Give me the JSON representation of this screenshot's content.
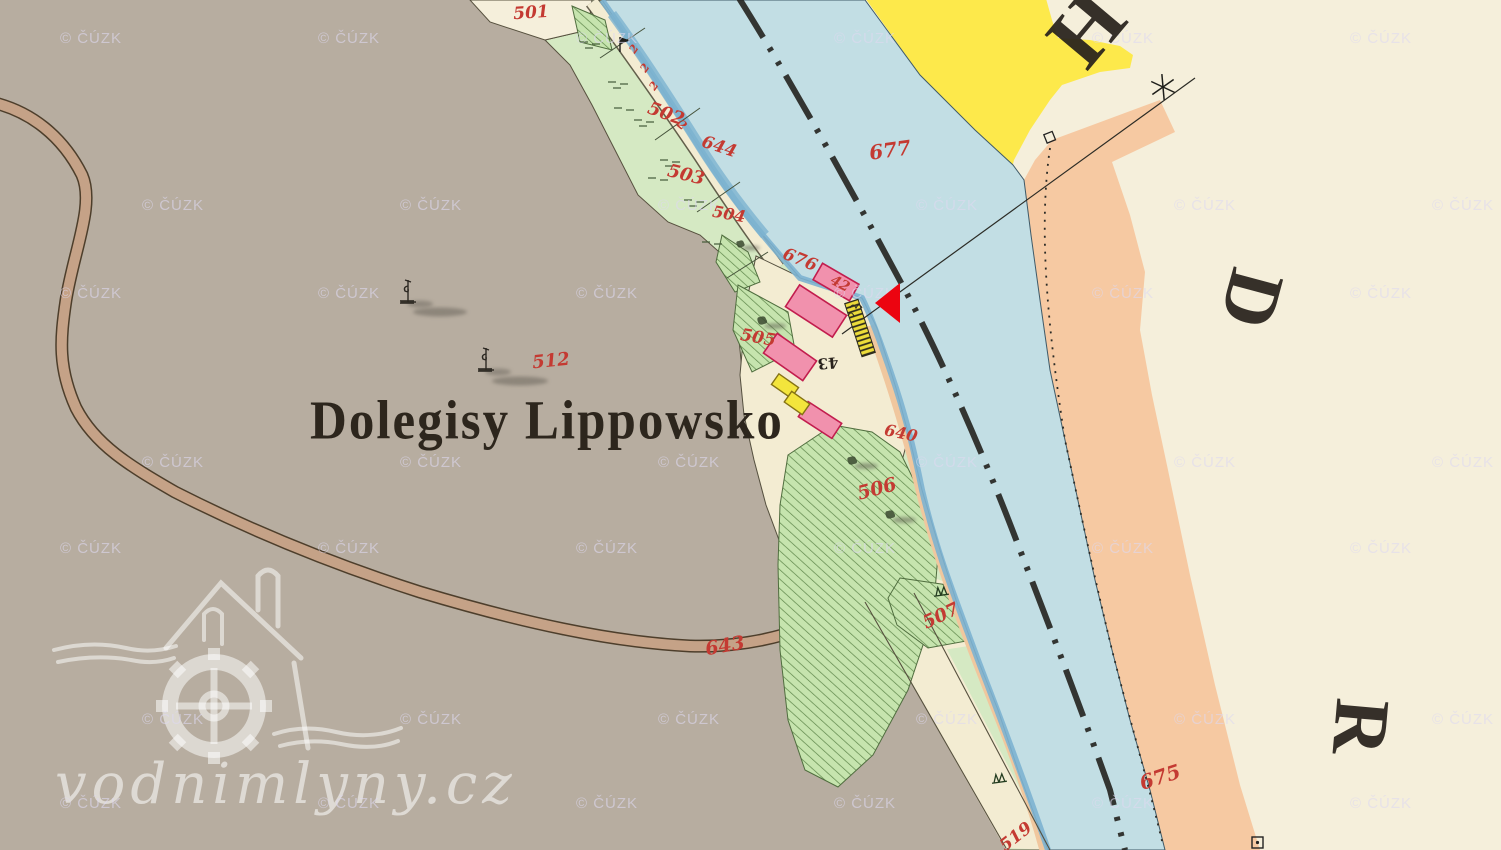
{
  "map": {
    "place_label": "Dolegisy Lippowsko",
    "sheet_letters": [
      {
        "name": "sheet-letter-h",
        "char": "H",
        "x": 1086,
        "y": 28,
        "rot": -50,
        "size": 86
      },
      {
        "name": "sheet-letter-d",
        "char": "D",
        "x": 1252,
        "y": 299,
        "rot": 105,
        "size": 78
      },
      {
        "name": "sheet-letter-r",
        "char": "R",
        "x": 1361,
        "y": 727,
        "rot": 95,
        "size": 78
      }
    ],
    "labels": [
      {
        "name": "parcel-label-501",
        "text": "501",
        "x": 531,
        "y": 13,
        "rot": -4,
        "size": 17,
        "color": "red"
      },
      {
        "name": "parcel-label-502",
        "text": "502",
        "x": 666,
        "y": 114,
        "rot": 20,
        "size": 18,
        "color": "red"
      },
      {
        "name": "strip-mark-2d",
        "text": "2",
        "x": 682,
        "y": 125,
        "rot": 40,
        "size": 12,
        "color": "red"
      },
      {
        "name": "parcel-label-503",
        "text": "503",
        "x": 686,
        "y": 175,
        "rot": 14,
        "size": 18,
        "color": "red"
      },
      {
        "name": "parcel-label-644",
        "text": "644",
        "x": 719,
        "y": 147,
        "rot": 18,
        "size": 17,
        "color": "red"
      },
      {
        "name": "parcel-label-504",
        "text": "504",
        "x": 729,
        "y": 214,
        "rot": 10,
        "size": 16,
        "color": "red"
      },
      {
        "name": "parcel-label-676",
        "text": "676",
        "x": 800,
        "y": 260,
        "rot": 22,
        "size": 17,
        "color": "red"
      },
      {
        "name": "house-number-42",
        "text": "42",
        "x": 840,
        "y": 284,
        "rot": 28,
        "size": 14,
        "color": "red"
      },
      {
        "name": "parcel-label-505",
        "text": "505",
        "x": 758,
        "y": 338,
        "rot": 10,
        "size": 17,
        "color": "red"
      },
      {
        "name": "house-number-43",
        "text": "43",
        "x": 828,
        "y": 363,
        "rot": 175,
        "size": 15,
        "color": "black"
      },
      {
        "name": "parcel-label-640",
        "text": "640",
        "x": 901,
        "y": 433,
        "rot": 12,
        "size": 16,
        "color": "red"
      },
      {
        "name": "parcel-label-506",
        "text": "506",
        "x": 877,
        "y": 489,
        "rot": -15,
        "size": 19,
        "color": "red"
      },
      {
        "name": "parcel-label-507",
        "text": "507",
        "x": 941,
        "y": 616,
        "rot": -25,
        "size": 18,
        "color": "red"
      },
      {
        "name": "parcel-label-643",
        "text": "643",
        "x": 725,
        "y": 646,
        "rot": -10,
        "size": 19,
        "color": "red"
      },
      {
        "name": "parcel-label-519",
        "text": "519",
        "x": 1016,
        "y": 837,
        "rot": -38,
        "size": 17,
        "color": "red"
      },
      {
        "name": "parcel-label-512",
        "text": "512",
        "x": 551,
        "y": 361,
        "rot": -6,
        "size": 18,
        "color": "red"
      },
      {
        "name": "river-label-677",
        "text": "677",
        "x": 890,
        "y": 150,
        "rot": -8,
        "size": 20,
        "color": "red"
      },
      {
        "name": "river-label-675",
        "text": "675",
        "x": 1160,
        "y": 777,
        "rot": -18,
        "size": 20,
        "color": "red"
      },
      {
        "name": "strip-mark-2a",
        "text": "2",
        "x": 634,
        "y": 49,
        "rot": -55,
        "size": 11,
        "color": "red"
      },
      {
        "name": "strip-mark-2b",
        "text": "2",
        "x": 645,
        "y": 68,
        "rot": -55,
        "size": 11,
        "color": "red"
      },
      {
        "name": "strip-mark-2c",
        "text": "2",
        "x": 654,
        "y": 86,
        "rot": -55,
        "size": 11,
        "color": "red"
      }
    ]
  },
  "marker": {
    "label": "mill-location"
  },
  "watermark": {
    "text": "© ČÚZK",
    "gridA": {
      "x0": 60,
      "y0": 30,
      "dx": 258,
      "dy": 255,
      "cols": 6,
      "rows": 4
    },
    "gridB": {
      "x0": 142,
      "y0": 197,
      "dx": 258,
      "dy": 257,
      "cols": 6,
      "rows": 3
    }
  },
  "logo": {
    "text": "vodnimlyny.cz"
  },
  "colors": {
    "paper": "#f5efdb",
    "gray_field": "#b7ada0",
    "green_band": "#d5e9c3",
    "green_hatch_bg": "#c6e4ae",
    "green_hatch_line": "#5d8549",
    "river": "#c2dee4",
    "river_bank": "#7db3d0",
    "yellow_road": "#fde94b",
    "salmon": "#f6c9a2",
    "salmon_bank": "#f0c79e",
    "cream_strip": "#f3ecd2",
    "road_tan": "#c5a287",
    "road_edge": "#4d3e2b",
    "pink_building": "#f191ad",
    "pink_outline": "#c21d4e",
    "yellow_building": "#f3e53c",
    "yellow_outline": "#857314",
    "ink_red": "#c43a32",
    "ink_black": "#28221c",
    "marker_red": "#ec0410",
    "watermark": "rgba(222,217,240,0.6)",
    "logo_white": "rgba(255,255,255,0.52)"
  }
}
